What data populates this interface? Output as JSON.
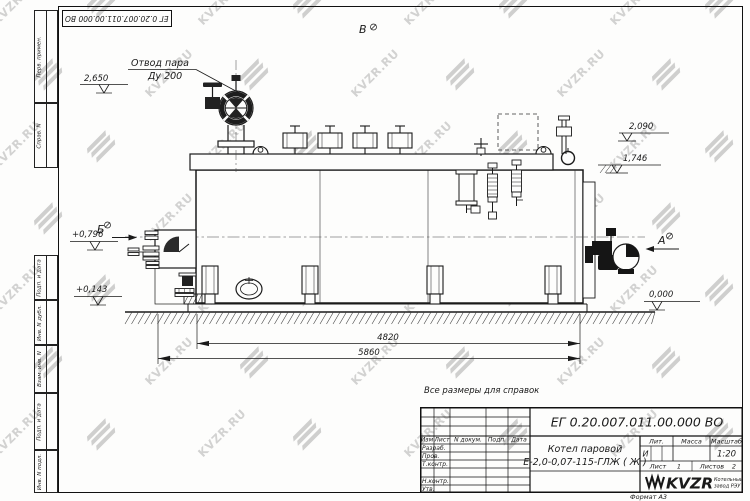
{
  "watermark": {
    "text": "KVZR.RU"
  },
  "frame": {
    "doc_number": "ЕГ 0.20.007.011.00.000  ВО",
    "margin_labels": [
      "Перв. примен.",
      "Справ. N",
      "Подп. и дата",
      "Инв. N дубл.",
      "Взам. инв. N",
      "Подп. и дата",
      "Инв. N подл."
    ],
    "format_label": "Формат А3"
  },
  "drawing": {
    "note": "Все размеры для справок",
    "callout_line1": "Отвод пара",
    "callout_line2": "Ду 200",
    "view_labels": {
      "a": "А",
      "b": "Б",
      "v": "В"
    },
    "levels": {
      "valve_top": "2,650",
      "right_upper": "2,090",
      "right_lower": "1,746",
      "ground": "0,000",
      "left_upper": "+0,796",
      "left_lower": "+0,143"
    },
    "dims": {
      "inner": "4820",
      "overall": "5860"
    }
  },
  "title_block": {
    "doc_number": "ЕГ 0.20.007.011.00.000  ВО",
    "product_name_line1": "Котел паровой",
    "product_name_line2": "Е-2,0-0,07-115-ГЛЖ ( Ж )",
    "header_cols": [
      "Изм",
      "Лист",
      "N докум.",
      "Подп.",
      "Дата"
    ],
    "row_labels": [
      "Разраб.",
      "Пров.",
      "Т.контр.",
      "Н.контр.",
      "Утв."
    ],
    "lit_label": "Лит.",
    "lit_value": "И",
    "mass_label": "Масса",
    "scale_label": "Масштаб",
    "scale_value": "1:20",
    "sheet_label": "Лист",
    "sheet_value": "1",
    "sheets_label": "Листов",
    "sheets_value": "2",
    "company": {
      "logo_text": "KVZR",
      "tagline_line1": "Котельный",
      "tagline_line2": "завод РЭУ"
    }
  }
}
